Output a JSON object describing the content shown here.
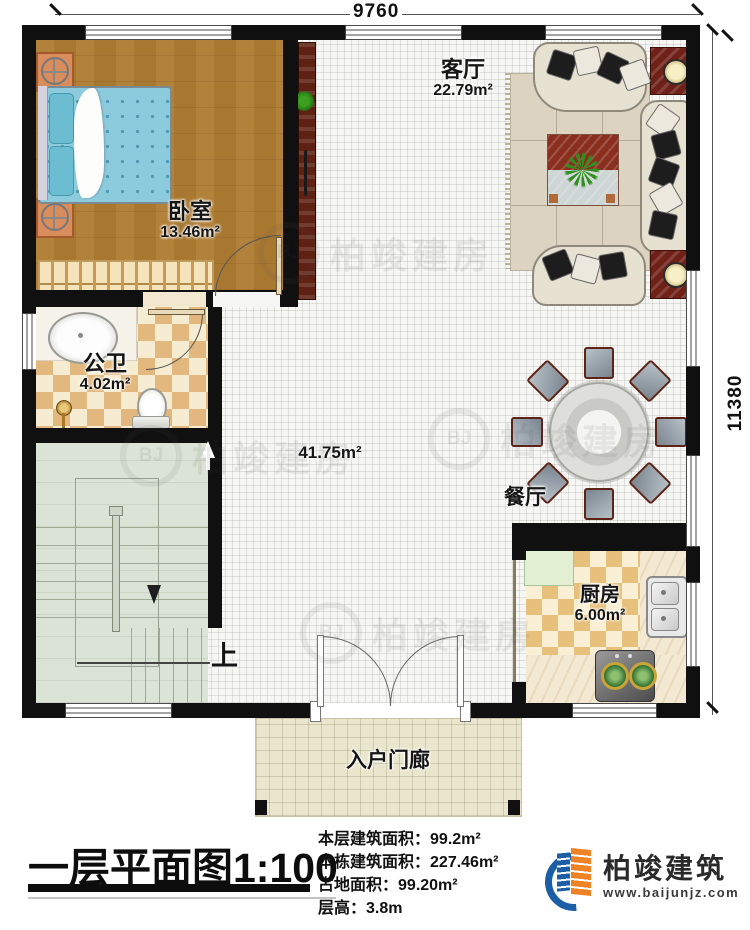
{
  "dimensions": {
    "width_label": "9760",
    "height_label": "11380"
  },
  "rooms": {
    "bedroom": {
      "name": "卧室",
      "area": "13.46m²"
    },
    "living_room": {
      "name": "客厅",
      "area": "22.79m²"
    },
    "bathroom": {
      "name": "公卫",
      "area": "4.02m²"
    },
    "hall": {
      "area": "41.75m²"
    },
    "dining_room": {
      "name": "餐厅"
    },
    "kitchen": {
      "name": "厨房",
      "area": "6.00m²"
    },
    "porch": {
      "name": "入户门廊"
    },
    "stairs": {
      "direction_label": "上"
    }
  },
  "title_block": {
    "title": "一层平面图",
    "scale": "1:100",
    "stats": [
      {
        "label": "本层建筑面积：",
        "value": "99.2m²"
      },
      {
        "label": "本栋建筑面积：",
        "value": "227.46m²"
      },
      {
        "label": "占地面积：",
        "value": "99.20m²"
      },
      {
        "label": "层高：",
        "value": "3.8m"
      }
    ],
    "brand": {
      "name": "柏竣建筑",
      "website": "www.baijunjz.com"
    }
  },
  "watermark": {
    "text": "柏竣建房",
    "badge": "BJ"
  },
  "colors": {
    "wall": "#101010",
    "brand_blue": "#1b5ea6",
    "brand_orange": "#f08223"
  }
}
